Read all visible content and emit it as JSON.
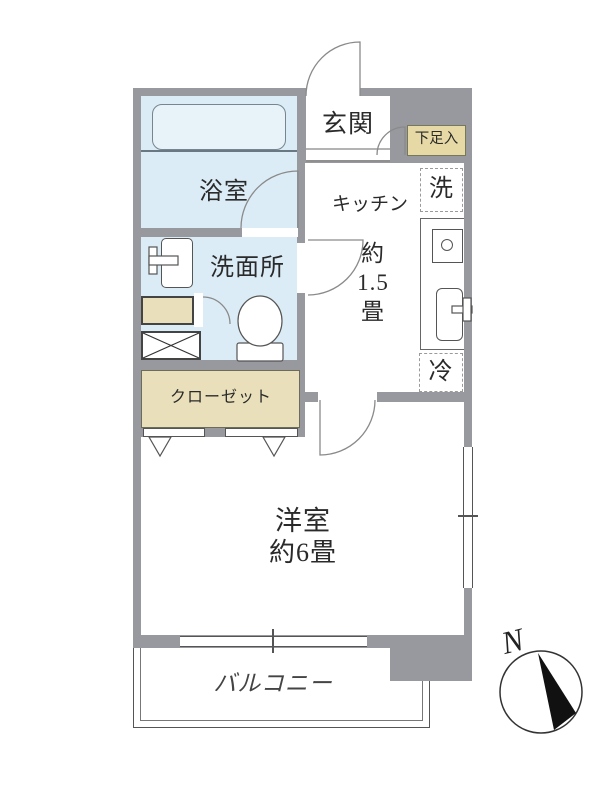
{
  "rooms": {
    "genkan": "玄関",
    "shoe_cabinet": "下足入",
    "bathroom": "浴室",
    "washroom": "洗面所",
    "kitchen": "キッチン",
    "kitchen_size": [
      "約",
      "1.5",
      "畳"
    ],
    "washer": "洗",
    "fridge": "冷",
    "closet": "クローゼット",
    "western_room": "洋室",
    "western_room_size": "約6畳",
    "balcony": "バルコニー"
  },
  "compass": {
    "north": "N"
  },
  "colors": {
    "wall": "#97999e",
    "wet_area": "#dcecf6",
    "bathtub": "#e7f2f9",
    "storage": "#e9dfba",
    "shoe_cabinet": "#e6d9a5",
    "line": "#555555",
    "text": "#2a2a2a"
  }
}
